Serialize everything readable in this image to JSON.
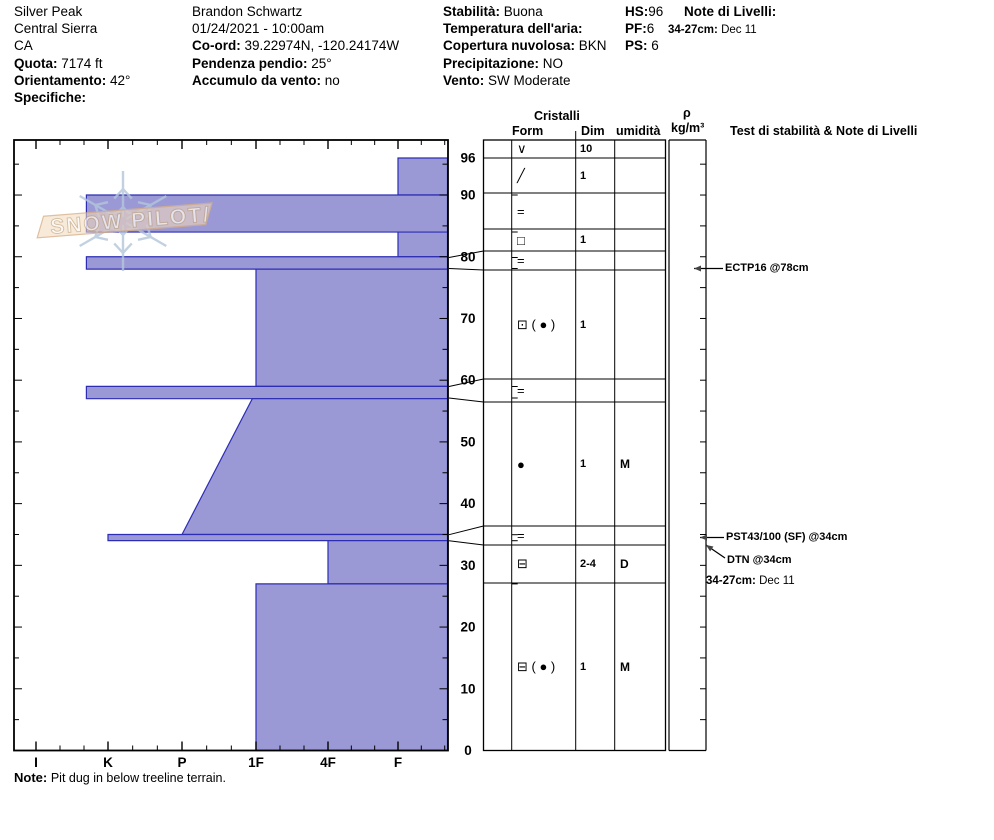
{
  "header": {
    "col1": {
      "site": "Silver Peak",
      "region": "Central Sierra",
      "state": "CA",
      "elev_label": "Quota:",
      "elev_value": "7174 ft",
      "aspect_label": "Orientamento:",
      "aspect_value": "42°",
      "spec_label": "Specifiche:",
      "spec_value": ""
    },
    "col2": {
      "observer": "Brandon Schwartz",
      "datetime": "01/24/2021 - 10:00am",
      "coord_label": "Co-ord:",
      "coord_value": "39.22974N, -120.24174W",
      "slope_label": "Pendenza pendio:",
      "slope_value": "25°",
      "windload_label": "Accumulo da vento:",
      "windload_value": "no"
    },
    "col3": {
      "stability_label": "Stabilità:",
      "stability_value": "Buona",
      "airtemp_label": "Temperatura dell'aria:",
      "airtemp_value": "",
      "sky_label": "Copertura nuvolosa:",
      "sky_value": "BKN",
      "precip_label": "Precipitazione:",
      "precip_value": "NO",
      "wind_label": "Vento:",
      "wind_value": "SW Moderate"
    },
    "col4": {
      "hs_label": "HS:",
      "hs_value": "96",
      "pf_label": "PF:",
      "pf_value": "6",
      "ps_label": "PS:",
      "ps_value": "6"
    },
    "col5": {
      "notes_label": "Note di Livelli:",
      "note_range": "34-27cm:",
      "note_value": "Dec 11"
    }
  },
  "logo": {
    "text": "SNOW PILOT/"
  },
  "chart_data": {
    "type": "bar",
    "orientation": "horizontal snow-profile (hand hardness vs depth)",
    "title": "Snow pit hardness profile",
    "xlabel": "hand hardness",
    "x_ticks": [
      "I",
      "K",
      "P",
      "1F",
      "4F",
      "F"
    ],
    "ylabel": "depth (cm)",
    "y_ticks": [
      96,
      90,
      80,
      70,
      60,
      50,
      40,
      30,
      20,
      10,
      0
    ],
    "ylim": [
      0,
      96
    ],
    "grid": false,
    "legend": "none",
    "layers": [
      {
        "top_cm": 96,
        "bottom_cm": 90,
        "hardness": "F",
        "h_top": 1.0,
        "h_bot": 1.0
      },
      {
        "top_cm": 90,
        "bottom_cm": 84,
        "hardness": "K+",
        "h_top": 5.3,
        "h_bot": 5.3
      },
      {
        "top_cm": 84,
        "bottom_cm": 80,
        "hardness": "F",
        "h_top": 1.0,
        "h_bot": 1.0
      },
      {
        "top_cm": 80,
        "bottom_cm": 78,
        "hardness": "K+",
        "h_top": 5.3,
        "h_bot": 5.3
      },
      {
        "top_cm": 78,
        "bottom_cm": 59,
        "hardness": "1F",
        "h_top": 3.0,
        "h_bot": 3.0
      },
      {
        "top_cm": 59,
        "bottom_cm": 57,
        "hardness": "K+",
        "h_top": 5.3,
        "h_bot": 5.3
      },
      {
        "top_cm": 57,
        "bottom_cm": 35,
        "hardness": "1F-P",
        "h_top": 3.05,
        "h_bot": 4.0
      },
      {
        "top_cm": 35,
        "bottom_cm": 34,
        "hardness": "K",
        "h_top": 5.0,
        "h_bot": 5.0
      },
      {
        "top_cm": 34,
        "bottom_cm": 27,
        "hardness": "4F",
        "h_top": 2.0,
        "h_bot": 2.0
      },
      {
        "top_cm": 27,
        "bottom_cm": 0,
        "hardness": "1F",
        "h_top": 3.0,
        "h_bot": 3.0
      }
    ]
  },
  "crystal_table": {
    "group_header": "Cristalli",
    "col_form": "Form",
    "col_dim": "Dim",
    "col_wet": "umidità",
    "rows": [
      {
        "form": "∨",
        "dim": "10",
        "wet": ""
      },
      {
        "form": "╱",
        "dim": "1",
        "wet": ""
      },
      {
        "form": "=",
        "dim": "",
        "wet": ""
      },
      {
        "form": "□",
        "dim": "1",
        "wet": ""
      },
      {
        "form": "=",
        "dim": "",
        "wet": ""
      },
      {
        "form": "⊡ ( ● )",
        "dim": "1",
        "wet": ""
      },
      {
        "form": "=",
        "dim": "",
        "wet": ""
      },
      {
        "form": "●",
        "dim": "1",
        "wet": "M"
      },
      {
        "form": "=",
        "dim": "",
        "wet": ""
      },
      {
        "form": "⊟",
        "dim": "2-4",
        "wet": "D"
      },
      {
        "form": "⊟ ( ● )",
        "dim": "1",
        "wet": "M"
      }
    ]
  },
  "density_column": {
    "rho": "ρ",
    "unit": "kg/m³"
  },
  "tests": {
    "header": "Test di stabilità & Note di Livelli",
    "ectp": "ECTP16 @78cm",
    "pst": "PST43/100 (SF) @34cm",
    "dtn": "DTN @34cm",
    "note_range": "34-27cm:",
    "note_value": "Dec 11"
  },
  "footnote": {
    "label": "Note:",
    "text": "Pit dug in below treeline terrain."
  },
  "colors": {
    "bar_fill": "#9a99d6",
    "bar_stroke": "#2d2db4",
    "frame": "#000000",
    "logo_band_fill": "#f2d8ba",
    "logo_band_stroke": "#d8b088",
    "logo_flake": "#b4c6da",
    "logo_text_fill": "#fdfbf7",
    "logo_text_stroke": "#c9ad89"
  }
}
